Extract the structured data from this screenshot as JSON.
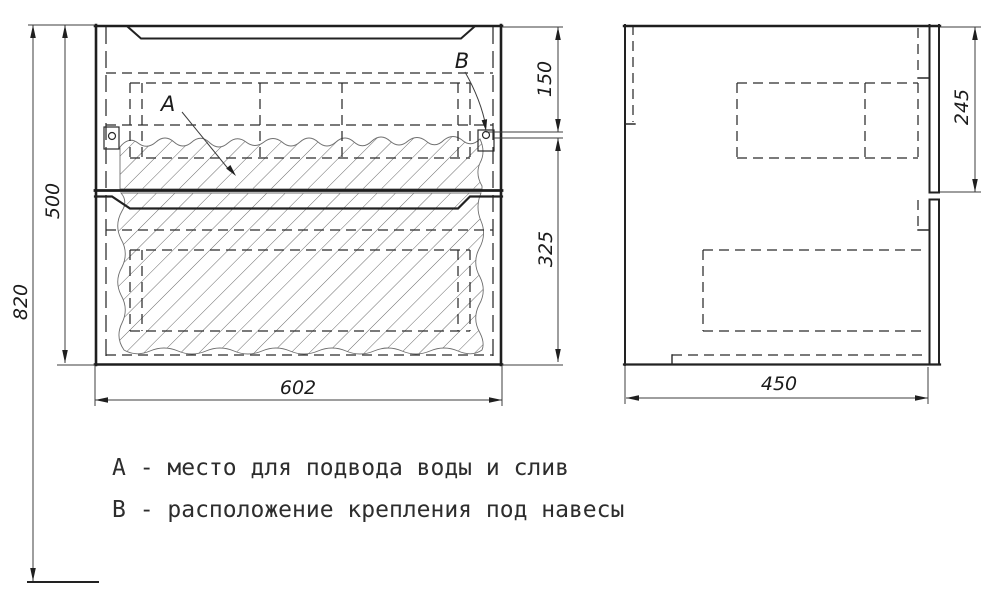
{
  "dimensions": {
    "overall_height": "820",
    "cabinet_height": "500",
    "cabinet_width": "602",
    "mount_from_top": "150",
    "mount_from_bottom": "325",
    "cabinet_depth": "450",
    "drawer_front_height": "245"
  },
  "callouts": {
    "a": "А",
    "b": "В"
  },
  "legend": {
    "line1": "А - место для подвода воды и слив",
    "line2": "В - расположение крепления под навесы"
  },
  "colors": {
    "line": "#2a2a2a",
    "hatch": "#6f6f6f",
    "background": "#ffffff"
  }
}
